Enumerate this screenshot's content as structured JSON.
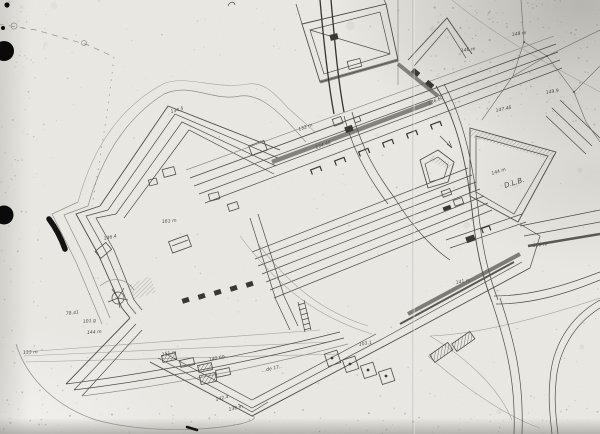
{
  "image": {
    "description": "Scanned hand-inked plan of a star fortress with outworks, glacis survey triangulation, roads and elevation annotations",
    "width": 600,
    "height": 434
  },
  "colors": {
    "paper": "#eceae5",
    "ink": "#4e4c45",
    "ink_faint": "#928f86",
    "ink_dark": "#35332e",
    "hole_punch": "#0a0a0a"
  },
  "annotations": [
    {
      "text": "148 m",
      "x": 512,
      "y": 36,
      "r": -8
    },
    {
      "text": "146 m",
      "x": 461,
      "y": 52,
      "r": -8
    },
    {
      "text": "149.9",
      "x": 546,
      "y": 94,
      "r": -10
    },
    {
      "text": "147.45",
      "x": 496,
      "y": 112,
      "r": -12
    },
    {
      "text": "144 m",
      "x": 492,
      "y": 175,
      "r": -18
    },
    {
      "text": "D.L.B.",
      "x": 505,
      "y": 188,
      "r": -18,
      "size": 7
    },
    {
      "text": "132 m",
      "x": 299,
      "y": 131,
      "r": -20
    },
    {
      "text": "134.40",
      "x": 316,
      "y": 149,
      "r": -20
    },
    {
      "text": "136.60",
      "x": 429,
      "y": 105,
      "r": -24
    },
    {
      "text": "134.5",
      "x": 171,
      "y": 113,
      "r": -15
    },
    {
      "text": "161 m",
      "x": 162,
      "y": 223,
      "r": -5
    },
    {
      "text": "146.4",
      "x": 104,
      "y": 240,
      "r": -12
    },
    {
      "text": "78.41",
      "x": 66,
      "y": 315,
      "r": -6
    },
    {
      "text": "101 g",
      "x": 83,
      "y": 323,
      "r": -6
    },
    {
      "text": "144 m",
      "x": 87,
      "y": 334,
      "r": -4
    },
    {
      "text": "133 m",
      "x": 23,
      "y": 354,
      "r": -3
    },
    {
      "text": "151 m",
      "x": 162,
      "y": 356,
      "r": -10
    },
    {
      "text": "140.60",
      "x": 209,
      "y": 361,
      "r": -10
    },
    {
      "text": "142.4",
      "x": 216,
      "y": 401,
      "r": -14
    },
    {
      "text": "139 m",
      "x": 229,
      "y": 411,
      "r": -14
    },
    {
      "text": "158 m",
      "x": 533,
      "y": 247,
      "r": -6
    },
    {
      "text": "141 m",
      "x": 456,
      "y": 284,
      "r": -10
    },
    {
      "text": "103.1",
      "x": 359,
      "y": 346,
      "r": -10
    },
    {
      "text": "…de 17..",
      "x": 262,
      "y": 372,
      "r": -12
    }
  ],
  "marks": [
    {
      "type": "hole-punch",
      "x": 4,
      "y": 51,
      "r": 10
    },
    {
      "type": "hole-punch",
      "x": 4,
      "y": 215,
      "r": 9.5
    },
    {
      "type": "ink-blob",
      "x": 7,
      "y": 5,
      "r": 2.6
    },
    {
      "type": "ink-blob",
      "x": 3,
      "y": 28,
      "r": 2
    },
    {
      "type": "ink-stroke",
      "path": "M49,219 C55,227 61,238 65,249",
      "w": 5.5
    },
    {
      "type": "ink-stroke",
      "path": "M187,427 L197,430",
      "w": 2.5
    }
  ]
}
